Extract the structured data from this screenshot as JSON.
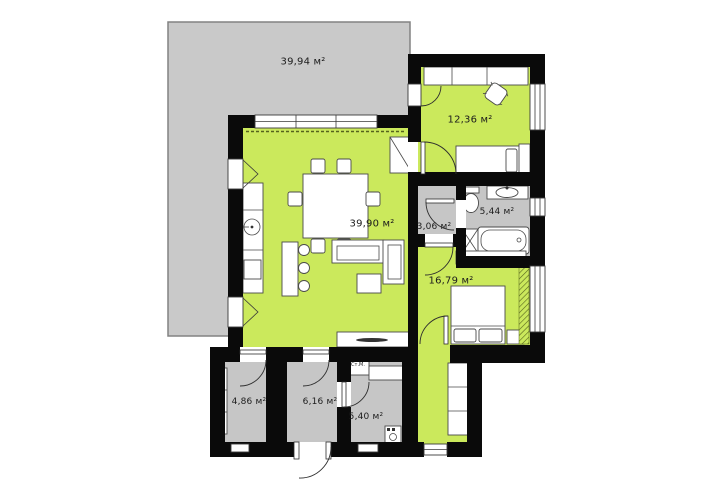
{
  "floor_plan": {
    "rooms": {
      "terrace": {
        "label": "39,94 м²"
      },
      "study": {
        "label": "12,36 м²"
      },
      "living_room": {
        "label": "39,90 м²"
      },
      "hall": {
        "label": "3,06 м²"
      },
      "bathroom": {
        "label": "5,44 м²"
      },
      "bedroom": {
        "label": "16,79 м²"
      },
      "storage": {
        "label": "4,86 м²"
      },
      "entry_hall": {
        "label": "6,16 м²"
      },
      "laundry": {
        "label": "5,40 м²"
      }
    },
    "annotations": {
      "washing_machine": "Ст.М."
    },
    "colors": {
      "room_fill": "#cbe95c",
      "terrace_fill": "#c9c9c9",
      "utility_fill": "#c6c6c6",
      "wall": "#0a0a0a",
      "furniture_line": "#4a4a4a",
      "background": "#ffffff"
    }
  }
}
